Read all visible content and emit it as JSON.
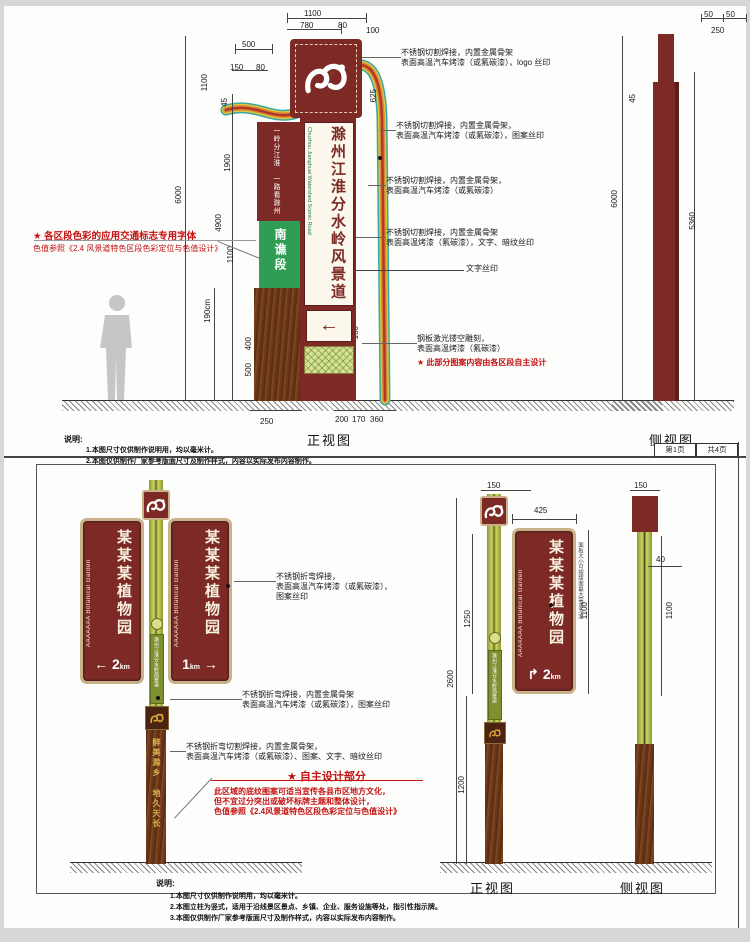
{
  "page": {
    "page_tab_left": "第1页",
    "page_tab_right": "共4页"
  },
  "colors": {
    "maroon": "#7d2a26",
    "tan_border": "#c9b28a",
    "green_section": "#2f9e54",
    "olive_pole": "#b7c14c",
    "wood_brown": "#6a3718",
    "note_red": "#c41212",
    "ribbon": [
      "#3aa8a0",
      "#e3c83d",
      "#d98a35",
      "#b23828"
    ]
  },
  "top_panel": {
    "front_view_label": "正视图",
    "side_view_label": "侧视图",
    "notes_title": "说明:",
    "notes": [
      "1.本图尺寸仅供制作说明用，均以毫米计。",
      "2.本图仅供制作厂家参考版面尺寸及制作样式，内容以实际发布内容制作。"
    ],
    "sign": {
      "main_text": "滁州江淮分水岭风景道",
      "english_text": "Chuzhou Jianghuai Watershed Scenic Road",
      "strip_text": "一岭分江淮 一路看滁州",
      "section_label": "南谯段",
      "arrow": "←"
    },
    "red_note_left": [
      "★ 各区段色彩的应用交通标志专用字体",
      "色值参照《2.4 风景道特色区段色彩定位与色值设计》"
    ],
    "red_note_bottom": "★ 此部分图案内容由各区段自主设计",
    "annotations": [
      {
        "x": 397,
        "y": 42,
        "lead": 45,
        "lines": [
          "不锈钢切割焊接，内置金属骨架",
          "表面高温汽车烤漆（或氟碳漆），logo 丝印"
        ]
      },
      {
        "x": 392,
        "y": 115,
        "lead": 16,
        "lines": [
          "不锈钢切割焊接，内置金属骨架，",
          "表面高温汽车烤漆（或氟碳漆），图案丝印"
        ]
      },
      {
        "x": 382,
        "y": 170,
        "lead": 18,
        "lines": [
          "不锈钢切割焊接，内置金属骨架，",
          "表面高温汽车烤漆（或氟碳漆）"
        ]
      },
      {
        "x": 382,
        "y": 222,
        "lead": 30,
        "lines": [
          "不锈钢切割焊接，内置金属骨架",
          "表面高温烤漆（氟碳漆），文字、暗纹丝印"
        ]
      },
      {
        "x": 462,
        "y": 258,
        "lead": 0,
        "lines": [
          "文字丝印"
        ]
      },
      {
        "x": 413,
        "y": 328,
        "lead": 55,
        "lines": [
          "钢板激光镂空雕刻，",
          "表面高温烤漆（氟碳漆）"
        ]
      }
    ],
    "dims": [
      {
        "t": "1100",
        "x": 300,
        "y": 3
      },
      {
        "t": "780",
        "x": 296,
        "y": 15
      },
      {
        "t": "80",
        "x": 334,
        "y": 15
      },
      {
        "t": "100",
        "x": 362,
        "y": 20
      },
      {
        "t": "500",
        "x": 238,
        "y": 34
      },
      {
        "t": "150",
        "x": 226,
        "y": 57
      },
      {
        "t": "80",
        "x": 252,
        "y": 57
      },
      {
        "t": "1100",
        "x": 196,
        "y": 68,
        "r": 1
      },
      {
        "t": "45",
        "x": 216,
        "y": 92,
        "r": 1
      },
      {
        "t": "1900",
        "x": 219,
        "y": 148,
        "r": 1
      },
      {
        "t": "6000",
        "x": 170,
        "y": 180,
        "r": 1
      },
      {
        "t": "4900",
        "x": 210,
        "y": 208,
        "r": 1
      },
      {
        "t": "1100",
        "x": 222,
        "y": 240,
        "r": 1
      },
      {
        "t": "190cm",
        "x": 199,
        "y": 293,
        "r": 1
      },
      {
        "t": "400",
        "x": 240,
        "y": 331,
        "r": 1
      },
      {
        "t": "500",
        "x": 240,
        "y": 357,
        "r": 1
      },
      {
        "t": "625",
        "x": 365,
        "y": 83,
        "r": 1
      },
      {
        "t": "60",
        "x": 344,
        "y": 297,
        "r": 1
      },
      {
        "t": "100",
        "x": 347,
        "y": 320,
        "r": 1
      },
      {
        "t": "250",
        "x": 256,
        "y": 411
      },
      {
        "t": "200",
        "x": 331,
        "y": 409
      },
      {
        "t": "170",
        "x": 348,
        "y": 409
      },
      {
        "t": "360",
        "x": 366,
        "y": 409
      },
      {
        "t": "50",
        "x": 700,
        "y": 4
      },
      {
        "t": "50",
        "x": 722,
        "y": 4
      },
      {
        "t": "250",
        "x": 707,
        "y": 20
      },
      {
        "t": "45",
        "x": 624,
        "y": 88,
        "r": 1
      },
      {
        "t": "6000",
        "x": 606,
        "y": 184,
        "r": 1
      },
      {
        "t": "5360",
        "x": 684,
        "y": 206,
        "r": 1
      }
    ]
  },
  "bottom_panel": {
    "front_view_label": "正视图",
    "side_view_label": "侧视图",
    "notes_title": "说明:",
    "notes": [
      "1.本图尺寸仅供制作说明用，均以毫米计。",
      "2.本图立柱为竖式，适用于沿线景区景点、乡镇、企业、服务设施等处，指引性指示牌。",
      "3.本图仅供制作厂家参考版面尺寸及制作样式，内容以实际发布内容制作。"
    ],
    "blade_left": {
      "chinese": "某某某植物园",
      "english": "AAAAAAA Botanical Garden",
      "arrow": "←",
      "distance": "2",
      "unit": "km"
    },
    "blade_right": {
      "chinese": "某某某植物园",
      "english": "AAAAAAA Botanical Garden",
      "arrow": "→",
      "distance": "1",
      "unit": "km"
    },
    "blade_single": {
      "chinese": "某某某植物园",
      "english": "AAAAAAA Botanical Garden",
      "arrow": "↱",
      "distance": "2",
      "unit": "km"
    },
    "pole_plate_text": "滁州江淮分水岭风景道",
    "pole_slogan": "醉美滁乡 地久天长",
    "vertical_note": "面板大小可按版面最大需求为准",
    "red_title": "★ 自主设计部分",
    "red_paragraph": [
      "此区域的底纹图案可适当宣传各县市区地方文化，",
      "但不宜过分突出或破坏标牌主题和整体设计，",
      "色值参照《2.4风景道特色区段色彩定位与色值设计》"
    ],
    "annotations": [
      {
        "x": 272,
        "y": 566,
        "lead": 42,
        "lines": [
          "不锈钢折弯焊接，",
          "表面高温汽车烤漆（或氟碳漆），",
          "图案丝印"
        ]
      },
      {
        "x": 238,
        "y": 684,
        "lead": 72,
        "lines": [
          "不锈钢折弯焊接，内置金属骨架",
          "表面高温汽车烤漆（或氟碳漆），图案丝印"
        ]
      },
      {
        "x": 182,
        "y": 736,
        "lead": 16,
        "lines": [
          "不锈钢折弯切割焊接，内置金属骨架，",
          "表面高温汽车烤漆（或氟碳漆）、图案、文字、暗纹丝印"
        ]
      }
    ],
    "dims": [
      {
        "t": "150",
        "x": 483,
        "y": 475
      },
      {
        "t": "425",
        "x": 530,
        "y": 500
      },
      {
        "t": "1100",
        "x": 576,
        "y": 596,
        "r": 1
      },
      {
        "t": "1250",
        "x": 459,
        "y": 604,
        "r": 1
      },
      {
        "t": "2600",
        "x": 442,
        "y": 664,
        "r": 1
      },
      {
        "t": "1200",
        "x": 453,
        "y": 770,
        "r": 1
      },
      {
        "t": "150",
        "x": 630,
        "y": 475
      },
      {
        "t": "40",
        "x": 652,
        "y": 549
      },
      {
        "t": "1100",
        "x": 661,
        "y": 596,
        "r": 1
      }
    ]
  }
}
